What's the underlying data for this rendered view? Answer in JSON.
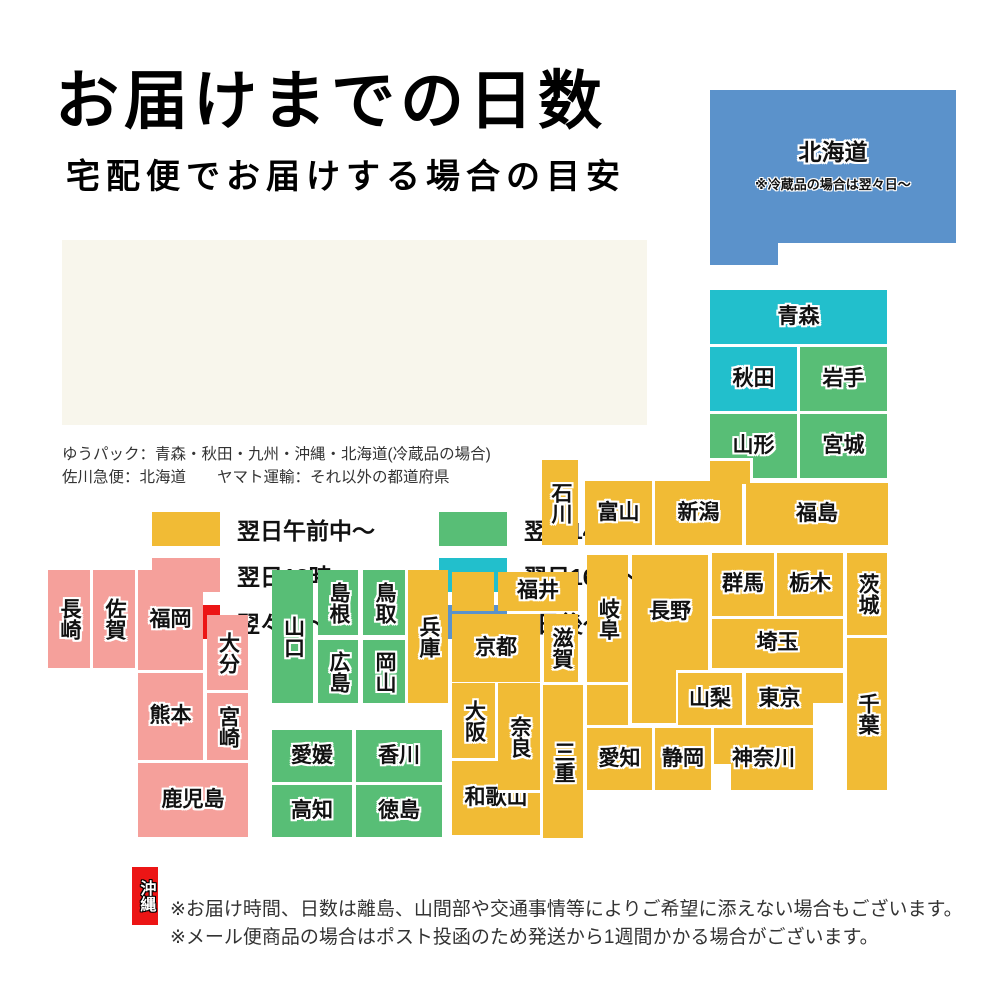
{
  "title": "お届けまでの日数",
  "subtitle": "宅配便でお届けする場合の目安",
  "colors": {
    "yellow": "#F1BB35",
    "pink": "#F5A09B",
    "red": "#EC1515",
    "green": "#58BE76",
    "cyan": "#22BFCC",
    "blue": "#5B92CB",
    "white": "#FFFFFF",
    "legend_bg": "#F8F6EC"
  },
  "legend": {
    "items": [
      {
        "label": "翌日午前中〜",
        "color": "yellow",
        "x": 90,
        "y": 272
      },
      {
        "label": "翌日18時〜",
        "color": "pink",
        "x": 90,
        "y": 318
      },
      {
        "label": "翌々日〜",
        "color": "red",
        "x": 90,
        "y": 365
      },
      {
        "label": "翌日14時〜",
        "color": "green",
        "x": 377,
        "y": 272
      },
      {
        "label": "翌日16時〜",
        "color": "cyan",
        "x": 377,
        "y": 318
      },
      {
        "label": "3日後〜",
        "color": "blue",
        "x": 377,
        "y": 365
      }
    ]
  },
  "carrier_notes": {
    "line1": "ゆうパック：青森・秋田・九州・沖縄・北海道(冷蔵品の場合)",
    "line2": "佐川急便：北海道　　ヤマト運輸：それ以外の都道府県"
  },
  "footer": {
    "line1": "※お届け時間、日数は離島、山間部や交通事情等によりご希望に添えない場合もございます。",
    "line2": "※メール便商品の場合はポスト投函のため発送から1週間かかる場合がございます。"
  },
  "map": {
    "blocks": [
      {
        "id": "hokkaido-tab",
        "label": "",
        "x": 710,
        "y": 243,
        "w": 68,
        "h": 22,
        "color": "blue"
      },
      {
        "id": "hokkaido",
        "label": "北海道",
        "note": "※冷蔵品の場合は翌々日〜",
        "x": 710,
        "y": 90,
        "w": 246,
        "h": 153,
        "color": "blue",
        "cls": "hokkaido"
      },
      {
        "id": "aomori",
        "label": "青森",
        "x": 710,
        "y": 290,
        "w": 177,
        "h": 54,
        "color": "cyan"
      },
      {
        "id": "akita",
        "label": "秋田",
        "x": 710,
        "y": 347,
        "w": 87,
        "h": 64,
        "color": "cyan"
      },
      {
        "id": "iwate",
        "label": "岩手",
        "x": 800,
        "y": 347,
        "w": 87,
        "h": 64,
        "color": "green"
      },
      {
        "id": "yamagata",
        "label": "山形",
        "x": 710,
        "y": 414,
        "w": 87,
        "h": 64,
        "color": "green"
      },
      {
        "id": "miyagi",
        "label": "宮城",
        "x": 800,
        "y": 414,
        "w": 87,
        "h": 64,
        "color": "green"
      },
      {
        "id": "niigata-tab",
        "label": "",
        "x": 710,
        "y": 458,
        "w": 43,
        "h": 26,
        "color": "yellow",
        "cls": "tab"
      },
      {
        "id": "ishikawa",
        "label": "石川",
        "x": 542,
        "y": 460,
        "w": 36,
        "h": 85,
        "color": "yellow",
        "v": true
      },
      {
        "id": "toyama",
        "label": "富山",
        "x": 585,
        "y": 481,
        "w": 67,
        "h": 64,
        "color": "yellow"
      },
      {
        "id": "niigata",
        "label": "新潟",
        "x": 655,
        "y": 481,
        "w": 87,
        "h": 64,
        "color": "yellow"
      },
      {
        "id": "fukushima",
        "label": "福島",
        "x": 746,
        "y": 483,
        "w": 142,
        "h": 62,
        "color": "yellow"
      },
      {
        "id": "gunma",
        "label": "群馬",
        "x": 712,
        "y": 553,
        "w": 62,
        "h": 63,
        "color": "yellow"
      },
      {
        "id": "tochigi",
        "label": "栃木",
        "x": 777,
        "y": 553,
        "w": 66,
        "h": 63,
        "color": "yellow"
      },
      {
        "id": "ibaraki",
        "label": "茨城",
        "x": 847,
        "y": 553,
        "w": 40,
        "h": 82,
        "color": "yellow",
        "v": true
      },
      {
        "id": "saitama",
        "label": "埼玉",
        "x": 712,
        "y": 619,
        "w": 131,
        "h": 49,
        "color": "yellow"
      },
      {
        "id": "chiba",
        "label": "千葉",
        "x": 847,
        "y": 638,
        "w": 40,
        "h": 152,
        "color": "yellow",
        "v": true
      },
      {
        "id": "fukui",
        "label": "福井",
        "x": 498,
        "y": 572,
        "w": 80,
        "h": 39,
        "color": "yellow"
      },
      {
        "id": "kyoto-tab",
        "label": "",
        "x": 452,
        "y": 572,
        "w": 42,
        "h": 39,
        "color": "yellow"
      },
      {
        "id": "kyoto",
        "label": "京都",
        "x": 452,
        "y": 614,
        "w": 88,
        "h": 68,
        "color": "yellow"
      },
      {
        "id": "shiga",
        "label": "滋賀",
        "x": 544,
        "y": 614,
        "w": 34,
        "h": 68,
        "color": "yellow",
        "v": true
      },
      {
        "id": "gifu",
        "label": "岐阜",
        "x": 587,
        "y": 555,
        "w": 41,
        "h": 127,
        "color": "yellow",
        "v": true
      },
      {
        "id": "nagano-ext",
        "label": "",
        "x": 632,
        "y": 640,
        "w": 44,
        "h": 83,
        "color": "yellow"
      },
      {
        "id": "nagano",
        "label": "長野",
        "x": 632,
        "y": 555,
        "w": 76,
        "h": 115,
        "color": "yellow"
      },
      {
        "id": "yamanashi",
        "label": "山梨",
        "x": 678,
        "y": 673,
        "w": 64,
        "h": 52,
        "color": "yellow"
      },
      {
        "id": "tokyo",
        "label": "東京",
        "x": 746,
        "y": 673,
        "w": 67,
        "h": 52,
        "color": "yellow"
      },
      {
        "id": "chiba-conn",
        "label": "",
        "x": 813,
        "y": 673,
        "w": 30,
        "h": 30,
        "color": "yellow"
      },
      {
        "id": "mie",
        "label": "三重",
        "x": 543,
        "y": 685,
        "w": 40,
        "h": 153,
        "color": "yellow",
        "v": true
      },
      {
        "id": "mie-tab",
        "label": "",
        "x": 587,
        "y": 685,
        "w": 41,
        "h": 40,
        "color": "yellow"
      },
      {
        "id": "aichi",
        "label": "愛知",
        "x": 587,
        "y": 728,
        "w": 65,
        "h": 62,
        "color": "yellow"
      },
      {
        "id": "shizuoka",
        "label": "静岡",
        "x": 655,
        "y": 728,
        "w": 56,
        "h": 62,
        "color": "yellow"
      },
      {
        "id": "kanagawa",
        "label": "神奈川",
        "x": 714,
        "y": 728,
        "w": 99,
        "h": 62,
        "color": "yellow"
      },
      {
        "id": "kanagawa-notch",
        "label": "",
        "x": 714,
        "y": 764,
        "w": 17,
        "h": 26,
        "color": "white"
      },
      {
        "id": "hyogo",
        "label": "兵庫",
        "x": 408,
        "y": 570,
        "w": 40,
        "h": 133,
        "color": "yellow",
        "v": true
      },
      {
        "id": "osaka",
        "label": "大阪",
        "x": 452,
        "y": 683,
        "w": 43,
        "h": 75,
        "color": "yellow",
        "v": true
      },
      {
        "id": "wakayama",
        "label": "和歌山",
        "x": 452,
        "y": 761,
        "w": 88,
        "h": 74,
        "color": "yellow"
      },
      {
        "id": "nara",
        "label": "奈良",
        "x": 498,
        "y": 683,
        "w": 42,
        "h": 110,
        "color": "yellow",
        "v": true,
        "cls": "nara"
      },
      {
        "id": "yamaguchi",
        "label": "山口",
        "x": 272,
        "y": 570,
        "w": 41,
        "h": 133,
        "color": "green",
        "v": true
      },
      {
        "id": "shimane",
        "label": "島根",
        "x": 318,
        "y": 570,
        "w": 40,
        "h": 65,
        "color": "green",
        "v": true
      },
      {
        "id": "tottori",
        "label": "鳥取",
        "x": 363,
        "y": 570,
        "w": 42,
        "h": 65,
        "color": "green",
        "v": true
      },
      {
        "id": "hiroshima",
        "label": "広島",
        "x": 318,
        "y": 640,
        "w": 40,
        "h": 63,
        "color": "green",
        "v": true
      },
      {
        "id": "okayama",
        "label": "岡山",
        "x": 363,
        "y": 640,
        "w": 42,
        "h": 63,
        "color": "green",
        "v": true
      },
      {
        "id": "ehime",
        "label": "愛媛",
        "x": 272,
        "y": 730,
        "w": 80,
        "h": 52,
        "color": "green"
      },
      {
        "id": "kagawa",
        "label": "香川",
        "x": 356,
        "y": 730,
        "w": 86,
        "h": 52,
        "color": "green"
      },
      {
        "id": "kochi",
        "label": "高知",
        "x": 272,
        "y": 785,
        "w": 80,
        "h": 52,
        "color": "green"
      },
      {
        "id": "tokushima",
        "label": "徳島",
        "x": 356,
        "y": 785,
        "w": 86,
        "h": 52,
        "color": "green"
      },
      {
        "id": "nagasaki",
        "label": "長崎",
        "x": 48,
        "y": 570,
        "w": 42,
        "h": 98,
        "color": "pink",
        "v": true
      },
      {
        "id": "saga",
        "label": "佐賀",
        "x": 93,
        "y": 570,
        "w": 42,
        "h": 98,
        "color": "pink",
        "v": true
      },
      {
        "id": "fukuoka",
        "label": "福岡",
        "x": 138,
        "y": 570,
        "w": 65,
        "h": 100,
        "color": "pink"
      },
      {
        "id": "oita",
        "label": "大分",
        "x": 207,
        "y": 615,
        "w": 41,
        "h": 75,
        "color": "pink",
        "v": true
      },
      {
        "id": "kumamoto",
        "label": "熊本",
        "x": 138,
        "y": 673,
        "w": 65,
        "h": 87,
        "color": "pink"
      },
      {
        "id": "miyazaki",
        "label": "宮崎",
        "x": 207,
        "y": 693,
        "w": 41,
        "h": 67,
        "color": "pink",
        "v": true
      },
      {
        "id": "kagoshima",
        "label": "鹿児島",
        "x": 138,
        "y": 763,
        "w": 110,
        "h": 74,
        "color": "pink"
      },
      {
        "id": "okinawa",
        "label": "沖縄",
        "x": 132,
        "y": 867,
        "w": 26,
        "h": 58,
        "color": "red",
        "v": true,
        "cls": "okinawa"
      }
    ]
  }
}
